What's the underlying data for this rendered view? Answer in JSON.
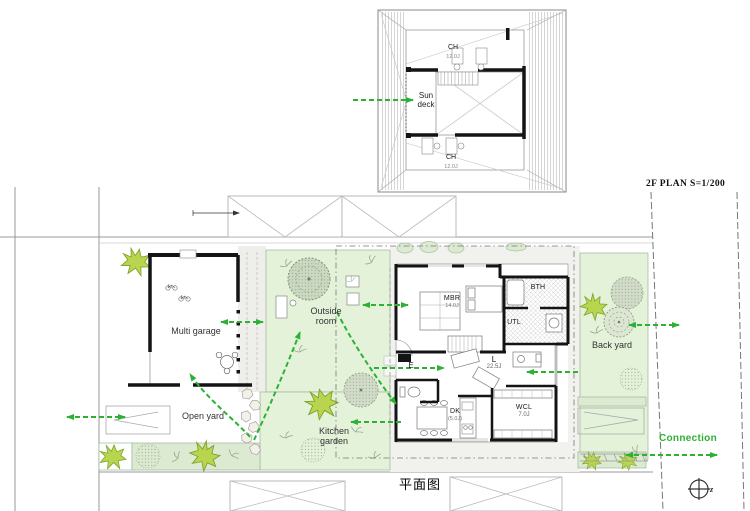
{
  "colors": {
    "arrow_green": "#2db135",
    "lawn_green": "#e4f2da",
    "strip_green": "#dcead2",
    "tree_green": "#cfdcc6",
    "bush_green": "#b9d44e",
    "wall_black": "#141414",
    "line_gray": "#999999"
  },
  "plan2f": {
    "title": "2F PLAN  S=1/200",
    "sun_deck_line1": "Sun",
    "sun_deck_line2": "deck",
    "ch_top": {
      "label": "CH",
      "area": "12.0J"
    },
    "ch_bottom": {
      "label": "CH",
      "area": "12.0J"
    }
  },
  "plan1f": {
    "rooms": {
      "mbr": {
        "label": "MBR",
        "area": "14.0J"
      },
      "bth": {
        "label": "BTH"
      },
      "utl": {
        "label": "UTL"
      },
      "living": {
        "label": "L",
        "area": "22.5J"
      },
      "entrance": {
        "label": "E"
      },
      "dk": {
        "label": "DK",
        "area": "(5.0J)"
      },
      "wcl": {
        "label": "WCL",
        "area": "7.0J"
      }
    },
    "areas": {
      "multi_garage": "Multi garage",
      "outside_room_line1": "Outside",
      "outside_room_line2": "room",
      "open_yard": "Open yard",
      "kitchen_garden_line1": "Kitchen",
      "kitchen_garden_line2": "garden",
      "back_yard": "Back yard"
    },
    "connection_label": "Connection",
    "compass_letter": "z"
  },
  "caption": "平面图"
}
